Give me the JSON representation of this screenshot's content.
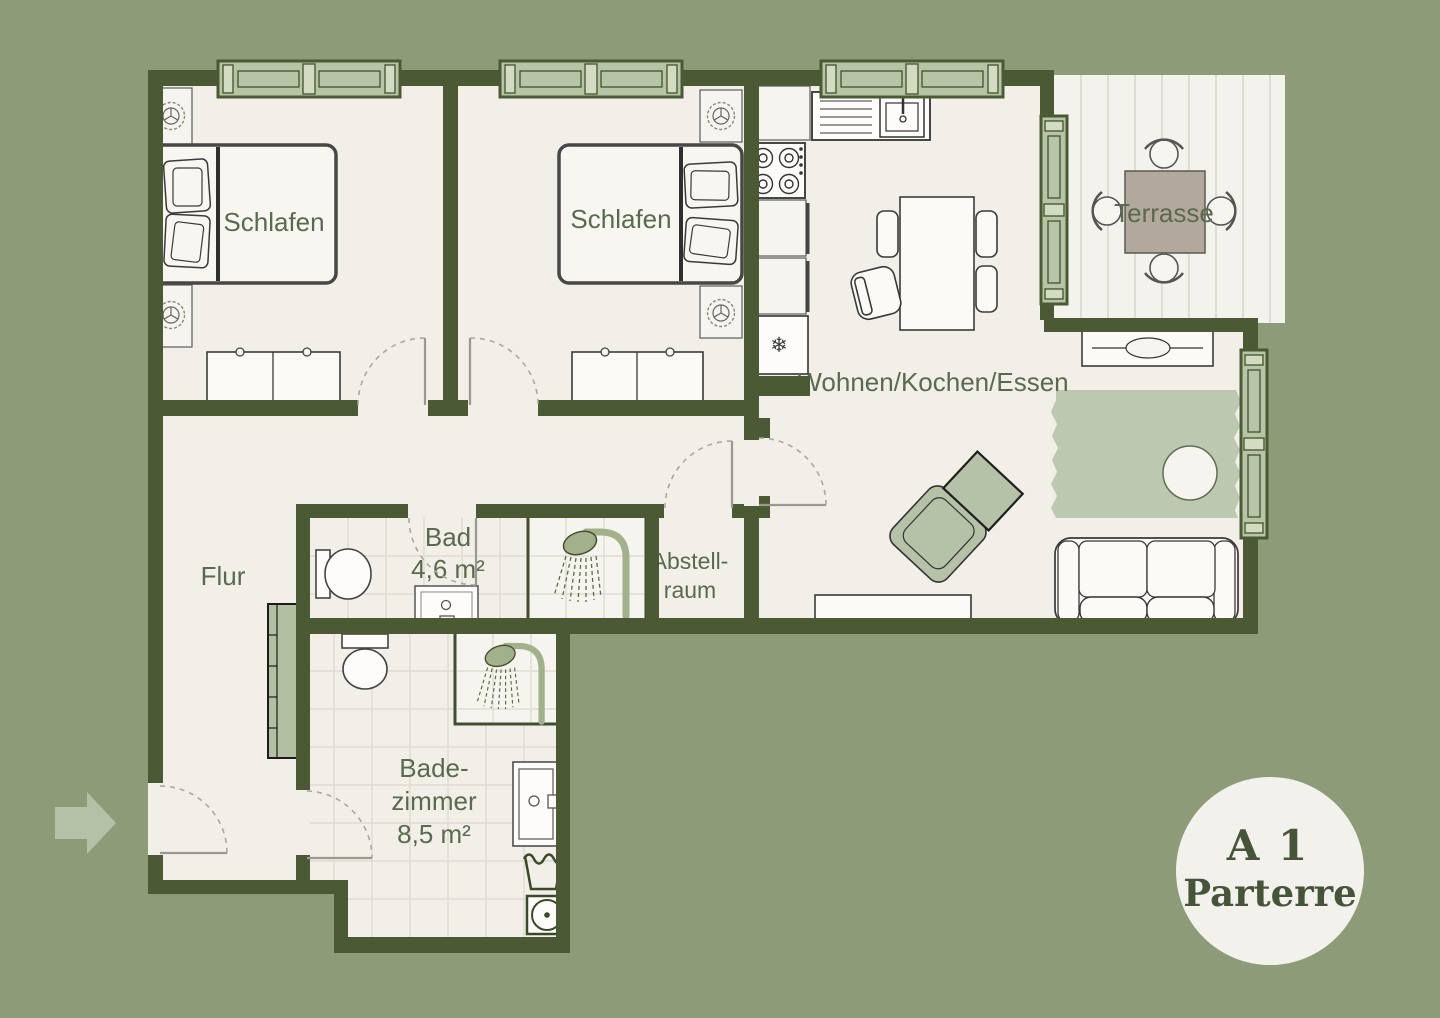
{
  "plan": {
    "rooms": {
      "bedroom1": {
        "label": "Schlafen"
      },
      "bedroom2": {
        "label": "Schlafen"
      },
      "living": {
        "label": "Wohnen/Kochen/Essen"
      },
      "terrace": {
        "label": "Terrasse"
      },
      "hall": {
        "label": "Flur"
      },
      "bath_small": {
        "label": "Bad",
        "area": "4,6 m²"
      },
      "storage": {
        "line1": "Abstell-",
        "line2": "raum"
      },
      "bath_large": {
        "line1": "Bade-",
        "line2": "zimmer",
        "area": "8,5 m²"
      }
    },
    "badge": {
      "line1": "A 1",
      "line2": "Parterre"
    },
    "icons": {
      "snowflake": "❄"
    },
    "colors": {
      "background": "#8e9b78",
      "wall": "#4b5a34",
      "floor": "#f1efe8",
      "window_green": "#b7c4a5",
      "furniture_sage": "#b6c2a7",
      "rug": "#bdc8b1",
      "terrace_table": "#b3a89c",
      "label_text": "#5a6a4e",
      "badge_bg": "#f2f1eb",
      "badge_text": "#46543a"
    }
  }
}
